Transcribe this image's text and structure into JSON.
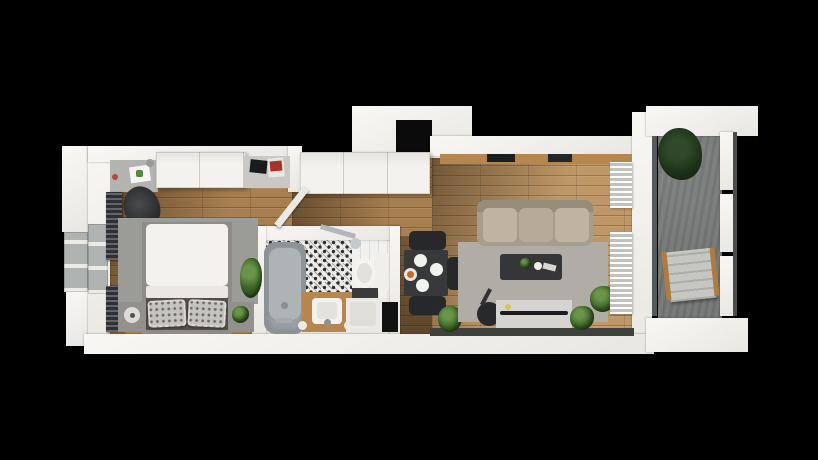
{
  "canvas": {
    "w": 818,
    "h": 460,
    "background": "#000000"
  },
  "palette": {
    "wall_white": "#f2f1ee",
    "wood_bedroom": "#a87f50",
    "wood_living": "#bf9867",
    "bathroom_tile_base": "#ececea",
    "balcony_concrete": "#787b7a",
    "rug_gray": "#9b9b98",
    "sofa_beige": "#a89d8a",
    "dark_furniture": "#27282a",
    "vanity_wood": "#b5874f",
    "plant_green": "#3c6527",
    "shaft_black": "#0b0b0c"
  },
  "rooms": [
    {
      "id": "bedroom"
    },
    {
      "id": "bathroom"
    },
    {
      "id": "hallway"
    },
    {
      "id": "living-room-kitchen"
    },
    {
      "id": "balcony"
    }
  ],
  "items": [
    {
      "name": "floor-bedroom-upper",
      "cls": "wood",
      "x": 106,
      "y": 158,
      "w": 186,
      "h": 80
    },
    {
      "name": "floor-bedroom-lower",
      "cls": "wood",
      "x": 106,
      "y": 236,
      "w": 150,
      "h": 100
    },
    {
      "name": "shade-bedroom",
      "x": 106,
      "y": 158,
      "w": 186,
      "h": 130,
      "bg": "linear-gradient(112deg, rgba(32,20,8,0.55), rgba(32,20,8,0) 60%)"
    },
    {
      "name": "floor-hallway",
      "cls": "wood",
      "x": 292,
      "y": 158,
      "w": 140,
      "h": 80
    },
    {
      "name": "floor-entry-corridor",
      "cls": "wood",
      "x": 396,
      "y": 236,
      "w": 36,
      "h": 100
    },
    {
      "name": "shade-hallway",
      "x": 292,
      "y": 158,
      "w": 140,
      "h": 80,
      "bg": "linear-gradient(100deg, rgba(32,20,8,0.5), rgba(32,20,8,0) 70%)"
    },
    {
      "name": "shade-corridor",
      "x": 396,
      "y": 236,
      "w": 36,
      "h": 100,
      "bg": "linear-gradient(180deg, rgba(20,14,6,0.35), rgba(20,14,6,0.5))"
    },
    {
      "name": "floor-living-kitchen",
      "cls": "wood-light",
      "x": 432,
      "y": 156,
      "w": 200,
      "h": 180
    },
    {
      "name": "shade-living",
      "x": 432,
      "y": 156,
      "w": 200,
      "h": 180,
      "bg": "linear-gradient(116deg, rgba(32,20,8,0.5), rgba(32,20,8,0) 52%)"
    },
    {
      "name": "floor-bathroom",
      "x": 264,
      "y": 238,
      "w": 128,
      "h": 98,
      "bg": "#e9e9e7"
    },
    {
      "name": "floor-bathroom-tile-pattern",
      "cls": "tile-ornament",
      "x": 266,
      "y": 238,
      "w": 86,
      "h": 64
    },
    {
      "name": "bathroom-wall-tile-right",
      "cls": "tile-white",
      "x": 352,
      "y": 240,
      "w": 38,
      "h": 58
    },
    {
      "name": "floor-balcony",
      "cls": "concrete",
      "x": 658,
      "y": 132,
      "w": 64,
      "h": 186
    },
    {
      "name": "wall-outer-pillar-top-left",
      "cls": "wall",
      "x": 62,
      "y": 146,
      "w": 28,
      "h": 86
    },
    {
      "name": "wall-outer-pillar-bottom-left",
      "cls": "wall",
      "x": 66,
      "y": 292,
      "w": 24,
      "h": 54
    },
    {
      "name": "window-left-outer",
      "cls": "window-frame",
      "x": 64,
      "y": 232,
      "w": 24,
      "h": 60
    },
    {
      "name": "wall-left-main",
      "cls": "wall",
      "x": 88,
      "y": 146,
      "w": 22,
      "h": 206
    },
    {
      "name": "window-left-inner",
      "cls": "window-frame",
      "x": 88,
      "y": 224,
      "w": 20,
      "h": 70
    },
    {
      "name": "wall-top-bedroom",
      "cls": "wall",
      "x": 88,
      "y": 146,
      "w": 214,
      "h": 16
    },
    {
      "name": "wall-bedroom-right",
      "cls": "wall",
      "x": 288,
      "y": 146,
      "w": 14,
      "h": 46
    },
    {
      "name": "wall-top-raised-block",
      "cls": "wall",
      "x": 352,
      "y": 106,
      "w": 120,
      "h": 52
    },
    {
      "name": "shaft-void",
      "x": 396,
      "y": 120,
      "w": 36,
      "h": 34,
      "bg": "#0b0b0c"
    },
    {
      "name": "wall-top-kitchen",
      "cls": "wall",
      "x": 430,
      "y": 136,
      "w": 204,
      "h": 20
    },
    {
      "name": "wall-right-living",
      "cls": "wall",
      "x": 632,
      "y": 112,
      "w": 20,
      "h": 240
    },
    {
      "name": "wall-balcony-top",
      "cls": "wall",
      "x": 646,
      "y": 106,
      "w": 112,
      "h": 30
    },
    {
      "name": "wall-bathroom-top",
      "cls": "wall",
      "x": 252,
      "y": 226,
      "w": 148,
      "h": 14
    },
    {
      "name": "wall-bathroom-left",
      "cls": "wall",
      "x": 252,
      "y": 226,
      "w": 14,
      "h": 110
    },
    {
      "name": "wall-bathroom-right",
      "cls": "wall",
      "x": 390,
      "y": 226,
      "w": 10,
      "h": 110
    },
    {
      "name": "wall-bottom-main",
      "cls": "wall",
      "x": 84,
      "y": 334,
      "w": 570,
      "h": 20
    },
    {
      "name": "glazing-bottom-living",
      "x": 430,
      "y": 328,
      "w": 204,
      "h": 8,
      "bg": "#3f423c"
    },
    {
      "name": "wall-balcony-bottom",
      "cls": "wall",
      "x": 646,
      "y": 318,
      "w": 102,
      "h": 34
    },
    {
      "name": "balcony-glass-frame-top",
      "cls": "wall",
      "x": 720,
      "y": 132,
      "w": 14,
      "h": 58
    },
    {
      "name": "balcony-glass-frame-mid",
      "cls": "wall",
      "x": 720,
      "y": 194,
      "w": 14,
      "h": 58
    },
    {
      "name": "balcony-glass-frame-bottom",
      "cls": "wall",
      "x": 720,
      "y": 256,
      "w": 14,
      "h": 60
    },
    {
      "name": "balcony-glass-rail",
      "x": 733,
      "y": 132,
      "w": 4,
      "h": 184,
      "bg": "#4a4d4e"
    },
    {
      "name": "balcony-door-glass",
      "x": 652,
      "y": 136,
      "w": 5,
      "h": 180,
      "bg": "#565a5b"
    },
    {
      "name": "desk",
      "x": 110,
      "y": 160,
      "w": 48,
      "h": 32,
      "bg": "#b3b4b2"
    },
    {
      "name": "desk-paper",
      "x": 130,
      "y": 166,
      "w": 20,
      "h": 16,
      "bg": "#f6f6f4",
      "rot": -8
    },
    {
      "name": "desk-paper-art",
      "x": 136,
      "y": 170,
      "w": 7,
      "h": 7,
      "bg": "#4f8a3d",
      "radius": "2px"
    },
    {
      "name": "desk-jar-1",
      "x": 146,
      "y": 159,
      "w": 8,
      "h": 8,
      "bg": "#9a9b99",
      "radius": "50%"
    },
    {
      "name": "desk-jar-2",
      "x": 157,
      "y": 157,
      "w": 8,
      "h": 8,
      "bg": "#8e8f8d",
      "radius": "50%"
    },
    {
      "name": "desk-knob-red",
      "x": 112,
      "y": 174,
      "w": 6,
      "h": 6,
      "bg": "#b34a3a",
      "radius": "50%"
    },
    {
      "name": "desk-chair",
      "x": 124,
      "y": 186,
      "w": 36,
      "h": 44,
      "bg": "radial-gradient(circle at 45% 40%, #4a4b4d, #272829 70%)",
      "radius": "50%",
      "rot": -18
    },
    {
      "name": "wardrobe",
      "cls": "cabinet",
      "x": 156,
      "y": 152,
      "w": 90,
      "h": 36
    },
    {
      "name": "sideboard",
      "x": 244,
      "y": 156,
      "w": 46,
      "h": 32,
      "bg": "#c9c8c4"
    },
    {
      "name": "sideboard-laptop",
      "x": 250,
      "y": 160,
      "w": 17,
      "h": 13,
      "bg": "#1a1b1d",
      "rot": 6
    },
    {
      "name": "sideboard-magazine",
      "x": 268,
      "y": 158,
      "w": 16,
      "h": 19,
      "bg": "#e9e7e3",
      "rot": -5
    },
    {
      "name": "sideboard-magazine-cover",
      "x": 270,
      "y": 161,
      "w": 12,
      "h": 10,
      "bg": "#a83325",
      "rot": -5
    },
    {
      "name": "radiator-bedroom-upper",
      "cls": "radiator-dark",
      "x": 106,
      "y": 192,
      "w": 16,
      "h": 68
    },
    {
      "name": "radiator-bedroom-lower",
      "cls": "radiator-dark",
      "x": 106,
      "y": 286,
      "w": 18,
      "h": 46
    },
    {
      "name": "rug-bedroom",
      "cls": "rug",
      "x": 118,
      "y": 218,
      "w": 140,
      "h": 86,
      "bg": "#9b9b98"
    },
    {
      "name": "bed-frame",
      "x": 142,
      "y": 222,
      "w": 90,
      "h": 112,
      "bg": "#8f8c87"
    },
    {
      "name": "bed-duvet",
      "x": 146,
      "y": 224,
      "w": 82,
      "h": 62,
      "bg": "#f3f2ef",
      "radius": "5px"
    },
    {
      "name": "bed-duvet-fold",
      "x": 146,
      "y": 286,
      "w": 82,
      "h": 12,
      "bg": "#e9e7e3",
      "radius": "2px"
    },
    {
      "name": "bed-pillow-deck",
      "x": 146,
      "y": 298,
      "w": 82,
      "h": 32,
      "bg": "#544f49"
    },
    {
      "name": "pillow-left",
      "cls": "pillow",
      "x": 148,
      "y": 300,
      "w": 38,
      "h": 27,
      "rot": -3
    },
    {
      "name": "pillow-right",
      "cls": "pillow",
      "x": 188,
      "y": 300,
      "w": 38,
      "h": 27,
      "rot": 3
    },
    {
      "name": "nightstand-left",
      "x": 118,
      "y": 302,
      "w": 28,
      "h": 30,
      "bg": "#93918d"
    },
    {
      "name": "nightstand-lamp",
      "x": 124,
      "y": 307,
      "w": 16,
      "h": 16,
      "bg": "#dddcd8",
      "radius": "50%"
    },
    {
      "name": "nightstand-lamp-dot",
      "x": 130,
      "y": 313,
      "w": 5,
      "h": 5,
      "bg": "#54504b",
      "radius": "50%"
    },
    {
      "name": "nightstand-right",
      "x": 228,
      "y": 302,
      "w": 26,
      "h": 30,
      "bg": "#93918d"
    },
    {
      "name": "nightstand-plant",
      "cls": "plant",
      "x": 232,
      "y": 306,
      "w": 17,
      "h": 17
    },
    {
      "name": "plant-bedroom",
      "cls": "plant",
      "x": 240,
      "y": 258,
      "w": 22,
      "h": 40
    },
    {
      "name": "entry-closet",
      "cls": "cabinet",
      "x": 300,
      "y": 152,
      "w": 130,
      "h": 42
    },
    {
      "name": "door-bedroom",
      "cls": "door",
      "x": 303,
      "y": 188,
      "w": 7,
      "h": 48,
      "bg": "#ebe9e5",
      "rot": 38
    },
    {
      "name": "bathtub",
      "cls": "tub",
      "x": 264,
      "y": 242,
      "w": 42,
      "h": 92,
      "bg": "#9aa0a3",
      "radius": "12px"
    },
    {
      "name": "bathtub-inner",
      "x": 269,
      "y": 248,
      "w": 32,
      "h": 72,
      "bg": "#aeb3b6",
      "radius": "10px"
    },
    {
      "name": "bathtub-drain",
      "x": 281,
      "y": 302,
      "w": 7,
      "h": 7,
      "bg": "#8a8f92",
      "radius": "50%"
    },
    {
      "name": "bathtub-faucet",
      "x": 276,
      "y": 318,
      "w": 16,
      "h": 5,
      "bg": "#a6aaac",
      "radius": "2px"
    },
    {
      "name": "shower-arm",
      "x": 320,
      "y": 229,
      "w": 36,
      "h": 5,
      "bg": "#b3b7b9",
      "rot": 16
    },
    {
      "name": "shower-head",
      "x": 350,
      "y": 238,
      "w": 11,
      "h": 11,
      "bg": "#c7cacc",
      "radius": "50%"
    },
    {
      "name": "vanity",
      "x": 302,
      "y": 292,
      "w": 52,
      "h": 40,
      "bg": "#b5874f"
    },
    {
      "name": "vanity-sink",
      "x": 312,
      "y": 298,
      "w": 30,
      "h": 26,
      "bg": "#f2f1ee",
      "radius": "4px"
    },
    {
      "name": "vanity-sink-basin",
      "x": 317,
      "y": 302,
      "w": 20,
      "h": 17,
      "bg": "#e3e2df",
      "radius": "3px"
    },
    {
      "name": "vanity-faucet",
      "x": 324,
      "y": 319,
      "w": 7,
      "h": 7,
      "bg": "#8f9396",
      "radius": "50%"
    },
    {
      "name": "vanity-knob-left",
      "x": 298,
      "y": 321,
      "w": 9,
      "h": 9,
      "bg": "#eceae7",
      "radius": "50%"
    },
    {
      "name": "vanity-knob-right",
      "x": 344,
      "y": 321,
      "w": 9,
      "h": 9,
      "bg": "#eceae7",
      "radius": "50%"
    },
    {
      "name": "toilet-tank",
      "x": 374,
      "y": 252,
      "w": 14,
      "h": 40,
      "bg": "#f0efec",
      "radius": "3px"
    },
    {
      "name": "toilet-bowl",
      "x": 352,
      "y": 258,
      "w": 24,
      "h": 30,
      "bg": "#f4f3f0",
      "radius": "50%"
    },
    {
      "name": "toilet-seat",
      "x": 357,
      "y": 263,
      "w": 15,
      "h": 20,
      "bg": "#e2e1de",
      "radius": "50%"
    },
    {
      "name": "bathroom-counter-dark",
      "x": 352,
      "y": 288,
      "w": 26,
      "h": 10,
      "bg": "#3a3b3d"
    },
    {
      "name": "washing-machine",
      "x": 346,
      "y": 298,
      "w": 34,
      "h": 34,
      "bg": "#eae9e5"
    },
    {
      "name": "washing-machine-lid",
      "x": 350,
      "y": 302,
      "w": 26,
      "h": 24,
      "bg": "#dfdedb",
      "radius": "3px"
    },
    {
      "name": "doorway-dark-opening",
      "x": 382,
      "y": 302,
      "w": 16,
      "h": 30,
      "bg": "#121213"
    },
    {
      "name": "kitchen-counter",
      "x": 440,
      "y": 154,
      "w": 192,
      "h": 10,
      "bg": "#b5874f"
    },
    {
      "name": "kitchen-cooktop",
      "x": 487,
      "y": 154,
      "w": 28,
      "h": 8,
      "bg": "#1c1d1f"
    },
    {
      "name": "kitchen-sink",
      "x": 548,
      "y": 154,
      "w": 24,
      "h": 8,
      "bg": "#24262a"
    },
    {
      "name": "dining-table",
      "x": 404,
      "y": 250,
      "w": 44,
      "h": 46,
      "bg": "#38393b",
      "radius": "2px"
    },
    {
      "name": "plate-1",
      "x": 414,
      "y": 254,
      "w": 13,
      "h": 13,
      "bg": "#f1f1ee",
      "radius": "50%"
    },
    {
      "name": "plate-2",
      "x": 430,
      "y": 263,
      "w": 13,
      "h": 13,
      "bg": "#f1f1ee",
      "radius": "50%"
    },
    {
      "name": "plate-3",
      "x": 416,
      "y": 279,
      "w": 13,
      "h": 13,
      "bg": "#f1f1ee",
      "radius": "50%"
    },
    {
      "name": "plate-food",
      "x": 404,
      "y": 268,
      "w": 13,
      "h": 13,
      "bg": "#e8e7e4",
      "radius": "50%"
    },
    {
      "name": "plate-food-item",
      "x": 407,
      "y": 271,
      "w": 7,
      "h": 7,
      "bg": "#c96a1e",
      "radius": "50%"
    },
    {
      "name": "dining-chair-north",
      "x": 409,
      "y": 231,
      "w": 37,
      "h": 19,
      "bg": "#27282a",
      "radius": "5px"
    },
    {
      "name": "dining-chair-east",
      "x": 447,
      "y": 257,
      "w": 22,
      "h": 33,
      "bg": "#27282a",
      "radius": "5px"
    },
    {
      "name": "dining-chair-south",
      "x": 409,
      "y": 296,
      "w": 37,
      "h": 19,
      "bg": "#27282a",
      "radius": "5px"
    },
    {
      "name": "plant-dining",
      "cls": "plant",
      "x": 438,
      "y": 306,
      "w": 24,
      "h": 26
    },
    {
      "name": "rug-living",
      "cls": "rug",
      "x": 458,
      "y": 242,
      "w": 150,
      "h": 80,
      "bg": "#b0ada6"
    },
    {
      "name": "sofa",
      "x": 477,
      "y": 200,
      "w": 116,
      "h": 46,
      "bg": "#a89d8a",
      "radius": "8px"
    },
    {
      "name": "sofa-back",
      "x": 477,
      "y": 200,
      "w": 116,
      "h": 12,
      "bg": "#968c7a",
      "radius": "8px 8px 0 0"
    },
    {
      "name": "sofa-cushion-1",
      "x": 483,
      "y": 208,
      "w": 34,
      "h": 34,
      "bg": "#bfb4a1",
      "radius": "6px"
    },
    {
      "name": "sofa-cushion-2",
      "x": 519,
      "y": 208,
      "w": 34,
      "h": 34,
      "bg": "#b6ab98",
      "radius": "6px"
    },
    {
      "name": "sofa-cushion-3",
      "x": 555,
      "y": 208,
      "w": 34,
      "h": 34,
      "bg": "#bfb4a1",
      "radius": "6px"
    },
    {
      "name": "coffee-table",
      "x": 500,
      "y": 254,
      "w": 62,
      "h": 26,
      "bg": "#353638",
      "radius": "3px"
    },
    {
      "name": "coffee-table-plant",
      "cls": "plant",
      "x": 520,
      "y": 258,
      "w": 11,
      "h": 11
    },
    {
      "name": "coffee-table-cup",
      "x": 534,
      "y": 262,
      "w": 8,
      "h": 8,
      "bg": "#f0efec",
      "radius": "50%"
    },
    {
      "name": "coffee-table-book",
      "x": 543,
      "y": 264,
      "w": 13,
      "h": 6,
      "bg": "#d8d7d3",
      "rot": 14
    },
    {
      "name": "floor-lamp",
      "x": 477,
      "y": 302,
      "w": 24,
      "h": 24,
      "bg": "#28292b",
      "radius": "50%"
    },
    {
      "name": "floor-lamp-arm",
      "x": 484,
      "y": 288,
      "w": 4,
      "h": 18,
      "bg": "#303134",
      "rot": 28
    },
    {
      "name": "tv-stand",
      "x": 496,
      "y": 300,
      "w": 76,
      "h": 28,
      "bg": "#d5d4d0"
    },
    {
      "name": "tv-screen",
      "x": 500,
      "y": 311,
      "w": 68,
      "h": 4,
      "bg": "#1b1c1e",
      "radius": "2px"
    },
    {
      "name": "tv-stand-deco",
      "x": 505,
      "y": 304,
      "w": 6,
      "h": 6,
      "bg": "#d9c153",
      "radius": "50%"
    },
    {
      "name": "plant-living-1",
      "cls": "plant",
      "x": 590,
      "y": 286,
      "w": 26,
      "h": 26
    },
    {
      "name": "plant-living-2",
      "cls": "plant",
      "x": 570,
      "y": 306,
      "w": 24,
      "h": 24
    },
    {
      "name": "radiator-living-upper",
      "cls": "radiator-white",
      "x": 610,
      "y": 162,
      "w": 22,
      "h": 46
    },
    {
      "name": "radiator-living-lower",
      "cls": "radiator-white",
      "x": 610,
      "y": 232,
      "w": 22,
      "h": 82
    },
    {
      "name": "plant-balcony",
      "cls": "plant-dark",
      "x": 658,
      "y": 128,
      "w": 44,
      "h": 52
    },
    {
      "name": "lounge-chair",
      "cls": "lounge",
      "x": 668,
      "y": 250,
      "w": 46,
      "h": 50,
      "rot": -6
    },
    {
      "name": "lounge-chair-frame-left",
      "x": 664,
      "y": 252,
      "w": 5,
      "h": 48,
      "bg": "#b07c3e",
      "rot": -6
    },
    {
      "name": "lounge-chair-frame-right",
      "x": 712,
      "y": 248,
      "w": 5,
      "h": 48,
      "bg": "#b07c3e",
      "rot": -6
    }
  ]
}
